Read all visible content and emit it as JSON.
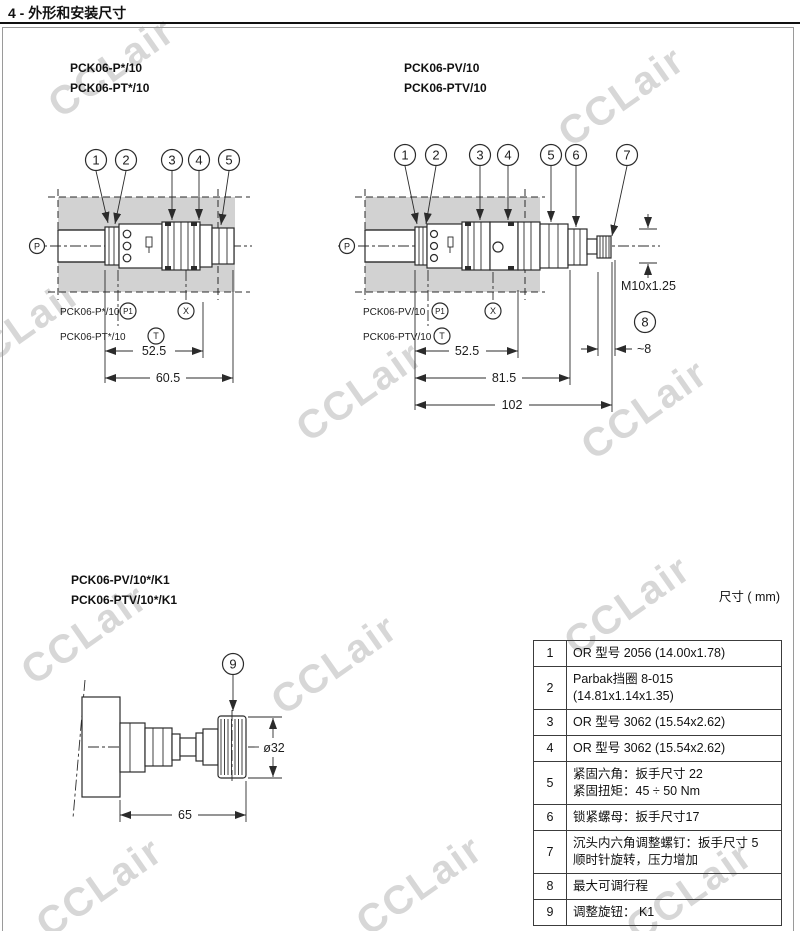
{
  "page": {
    "title": "4 - 外形和安装尺寸",
    "units_note": "尺寸 ( mm)",
    "watermark": "CCLair"
  },
  "drawing1": {
    "model_line1": "PCK06-P*/10",
    "model_line2": "PCK06-PT*/10",
    "callouts": [
      "1",
      "2",
      "3",
      "4",
      "5"
    ],
    "port_p": "P",
    "row1_model": "PCK06-P*/10",
    "row1_port": "P1",
    "row2_model": "PCK06-PT*/10",
    "row2_port": "T",
    "port_x": "X",
    "dim1": "52.5",
    "dim2": "60.5"
  },
  "drawing2": {
    "model_line1": "PCK06-PV/10",
    "model_line2": "PCK06-PTV/10",
    "callouts": [
      "1",
      "2",
      "3",
      "4",
      "5",
      "6",
      "7"
    ],
    "callout8": "8",
    "port_p": "P",
    "row1_model": "PCK06-PV/10",
    "row1_port": "P1",
    "row2_model": "PCK06-PTV/10",
    "row2_port": "T",
    "port_x": "X",
    "thread_label": "M10x1.25",
    "stroke_dim": "~8",
    "dim1": "52.5",
    "dim2": "81.5",
    "dim3": "102"
  },
  "drawing3": {
    "model_line1": "PCK06-PV/10*/K1",
    "model_line2": "PCK06-PTV/10*/K1",
    "callout9": "9",
    "dim_length": "65",
    "dim_dia": "ø32"
  },
  "table": {
    "rows": [
      {
        "num": "1",
        "lines": [
          "OR 型号 2056 (14.00x1.78)"
        ]
      },
      {
        "num": "2",
        "lines": [
          "Parbak挡圈 8-015 (14.81x1.14x1.35)"
        ]
      },
      {
        "num": "3",
        "lines": [
          "OR 型号 3062 (15.54x2.62)"
        ]
      },
      {
        "num": "4",
        "lines": [
          "OR 型号 3062 (15.54x2.62)"
        ]
      },
      {
        "num": "5",
        "lines": [
          "紧固六角：扳手尺寸 22",
          "紧固扭矩：45 ÷ 50 Nm"
        ]
      },
      {
        "num": "6",
        "lines": [
          "锁紧螺母：扳手尺寸17"
        ]
      },
      {
        "num": "7",
        "lines": [
          "沉头内六角调整螺钉：扳手尺寸 5",
          "顺时针旋转，压力增加"
        ]
      },
      {
        "num": "8",
        "lines": [
          "最大可调行程"
        ]
      },
      {
        "num": "9",
        "lines": [
          "调整旋钮： K1"
        ]
      }
    ]
  },
  "colors": {
    "line": "#2b2b2b",
    "manifold_fill": "#d2d2d2",
    "watermark": "#d7d7d7"
  }
}
